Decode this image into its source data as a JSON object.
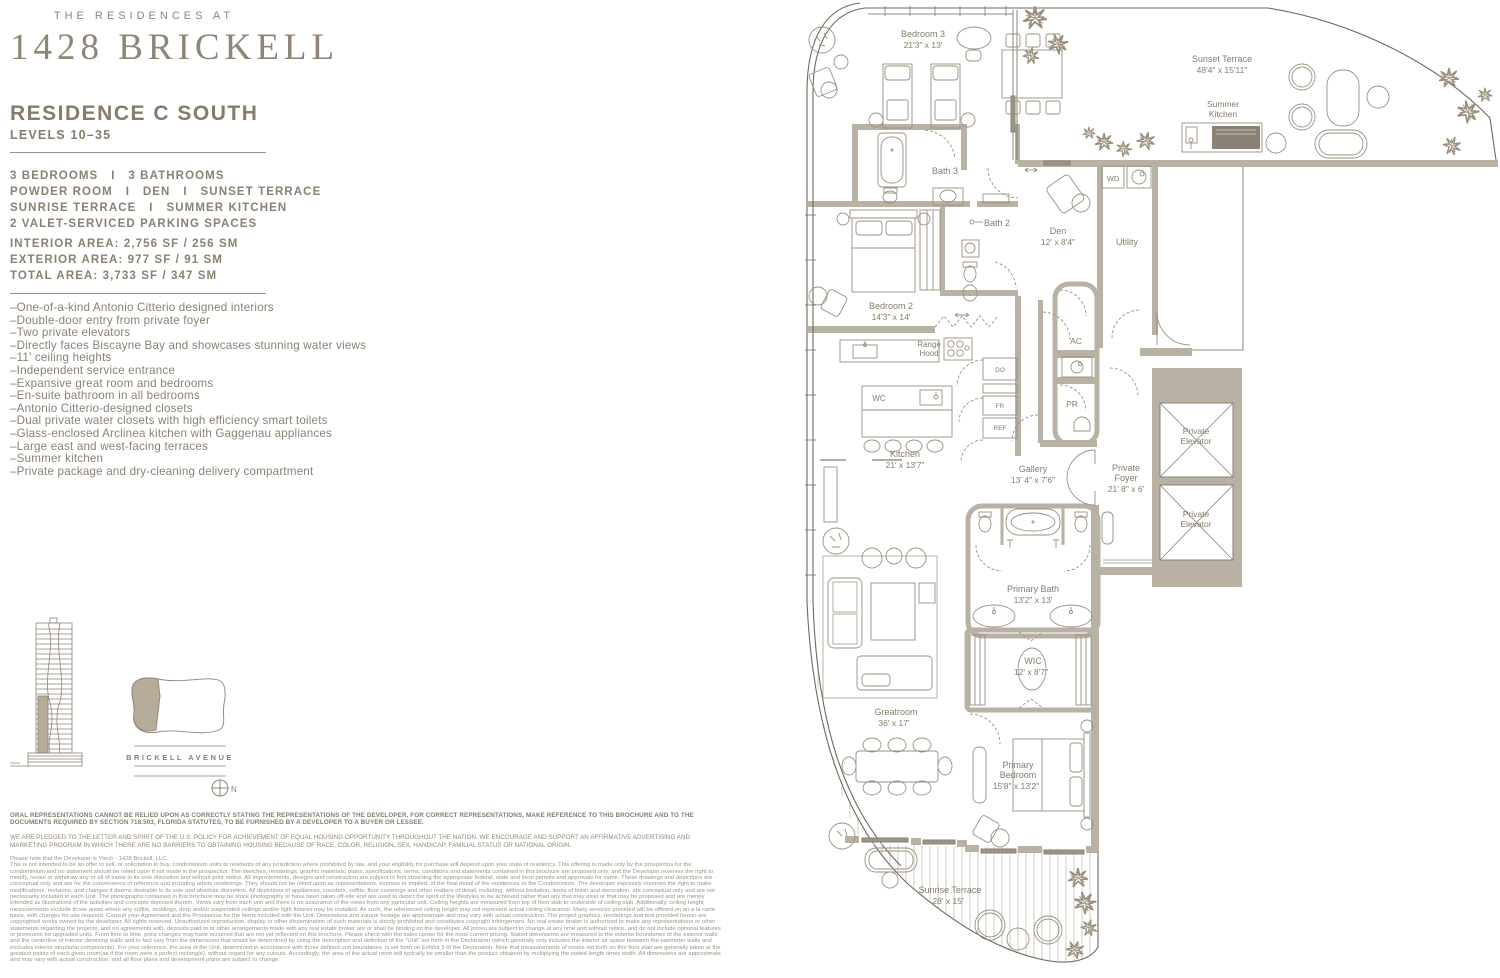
{
  "brand": {
    "tagline": "THE RESIDENCES AT",
    "name": "1428 BRICKELL"
  },
  "residence": {
    "title": "RESIDENCE C SOUTH",
    "levels": "LEVELS 10–35",
    "specs": [
      "3 BEDROOMS   I   3 BATHROOMS",
      "POWDER ROOM   I   DEN   I   SUNSET TERRACE",
      "SUNRISE TERRACE   I   SUMMER KITCHEN",
      "2 VALET-SERVICED PARKING SPACES"
    ],
    "areas": [
      "INTERIOR AREA: 2,756 SF / 256 SM",
      "EXTERIOR AREA: 977 SF / 91 SM",
      "TOTAL AREA: 3,733 SF / 347 SM"
    ],
    "features": [
      "–One-of-a-kind Antonio Citterio designed interiors",
      "–Double-door entry from private foyer",
      "–Two private elevators",
      "–Directly faces Biscayne Bay and showcases stunning water views",
      "–11' ceiling heights",
      "–Independent service entrance",
      "–Expansive great room and bedrooms",
      "–En-suite bathroom in all bedrooms",
      "–Antonio Citterio-designed closets",
      "–Dual private water closets with high efficiency smart toilets",
      "–Glass-enclosed Arclinea kitchen with Gaggenau appliances",
      "–Large east and west-facing terraces",
      "–Summer kitchen",
      "–Private package and dry-cleaning delivery compartment"
    ]
  },
  "site": {
    "street": "BRICKELL AVENUE",
    "compass_north": "N"
  },
  "plan": {
    "labels": {
      "bedroom3": "Bedroom 3",
      "bedroom3_dims": "21'3\" x 13'",
      "bath3": "Bath 3",
      "bath2": "Bath 2",
      "bedroom2": "Bedroom 2",
      "bedroom2_dims": "14'3\" x 14'",
      "den": "Den",
      "den_dims": "12' x 8'4\"",
      "utility": "Utility",
      "wd": "WD",
      "sunset_terrace": "Sunset Terrace",
      "sunset_terrace_dims": "48'4\" x 15'11\"",
      "summer_kitchen_1": "Summer",
      "summer_kitchen_2": "Kitchen",
      "range_hood_1": "Range",
      "range_hood_2": "Hood",
      "wc": "WC",
      "appliance_do": "DO",
      "appliance_fr": "FR",
      "appliance_ref": "REF",
      "ac": "AC",
      "pr": "PR",
      "kitchen": "Kitchen",
      "kitchen_dims": "21' x 13'7\"",
      "gallery": "Gallery",
      "gallery_dims": "13' 4\" x 7'6\"",
      "private_foyer_1": "Private",
      "private_foyer_2": "Foyer",
      "private_foyer_dims": "21' 8\" x 6'",
      "private_elevator_1": "Private",
      "private_elevator_2": "Elevator",
      "primary_bath": "Primary Bath",
      "primary_bath_dims": "13'2\" x 13'",
      "wic": "WIC",
      "wic_dims": "12' x 8'7\"",
      "greatroom": "Greatroom",
      "greatroom_dims": "36' x 17'",
      "primary_bedroom_1": "Primary",
      "primary_bedroom_2": "Bedroom",
      "primary_bedroom_dims": "15'8\" x 13'2\"",
      "sunrise_terrace": "Sunrise Terrace",
      "sunrise_terrace_dims": "28' x 15'"
    }
  },
  "footer": {
    "legal_bold": "ORAL REPRESENTATIONS CANNOT BE RELIED UPON AS CORRECTLY STATING THE REPRESENTATIONS OF THE DEVELOPER. FOR CORRECT REPRESENTATIONS, MAKE REFERENCE TO THIS BROCHURE AND TO THE DOCUMENTS REQUIRED BY SECTION 718.503, FLORIDA STATUTES, TO BE FURNISHED BY A DEVELOPER TO A BUYER OR LESSEE.",
    "fair_housing": "WE ARE PLEDGED TO THE LETTER AND SPIRIT OF THE U.S. POLICY FOR ACHIEVEMENT OF EQUAL HOUSING OPPORTUNITY THROUGHOUT THE NATION. WE ENCOURAGE AND SUPPORT AN AFFIRMATIVE ADVERTISING AND MARKETING PROGRAM IN WHICH THERE ARE NO BARRIERS TO OBTAINING HOUSING BECAUSE OF RACE, COLOR, RELIGION, SEX, HANDICAP, FAMILIAL STATUS OR NATIONAL ORIGIN.",
    "developer_note": "Please note that the Developer is Ytech - 1428 Brickell, LLC.",
    "fine_print": "This is not intended to be an offer to sell, or solicitation to buy, condominium units to residents of any jurisdiction where prohibited by law, and your eligibility for purchase will depend upon your state of residency. This offering is made only by the prospectus for the condominium and no statement should be relied upon if not made in the prospectus. The sketches, renderings, graphic materials, plans, specifications, terms, conditions and statements contained in this brochure are proposed only, and the Developer reserves the right to modify, revise or withdraw any or all of same in its sole discretion and without prior notice. All improvements, designs and construction are subject to first obtaining the appropriate federal, state and local permits and approvals for same. These drawings and depictions are conceptual only and are for the convenience of reference and including artists renderings. They should not be relied upon as representations, express or implied, of the final detail of the residences or the Condominium. The developer expressly reserves the right to make modifications, revisions, and changes it deems desirable in its sole and absolute discretion. All depictions of appliances, counters, soffits, floor coverings and other matters of detail, including, without limitation, items of finish and decoration, are conceptual only and are not necessarily included in each Unit. The photographs contained in this brochure may be stock photography or have been taken off-site and are used to depict the spirit of the lifestyles to be achieved rather than any that may exist or that may be proposed and are merely intended as illustrations of the activities and concepts depicted therein. Views vary from each unit and there is no assurance of the views from any particular unit. Ceiling heights are measured from top of floor slab to underside of ceiling slab. Additionally, ceiling height measurements exclude those areas where any soffits, moldings, drop and/or suspended ceilings and/or light fixtures may be installed. As such, the referenced ceiling height may not represent actual ceiling clearance. Many services provided will be offered on an a la carte basis, with charges for use required. Consult your Agreement and the Prospectus for the items included with the Unit. Dimensions and square footage are approximate and may vary with actual construction. The project graphics, renderings and text provided herein are copyrighted works owned by the developer. All rights reserved. Unauthorized reproduction, display or other dissemination of such materials is strictly prohibited and constitutes copyright infringement. No real estate broker is authorized to make any representations or other statements regarding the projects, and no agreements with, deposits paid to or other arrangements made with any real estate broker are or shall be binding on the developer. All prices are subject to change at any time and without notice, and do not include optional features or premiums for upgraded units. From time to time, price changes may have occurred that are not yet reflected on this brochure. Please check with the sales center for the most current pricing. Stated dimensions are measured to the exterior boundaries of the exterior walls and the centerline of interior demising walls and in fact vary from the dimensions that would be determined by using the description and definition of the \"Unit\" set forth in the Declaration (which generally only includes the interior air space between the perimeter walls and excludes interior structural components). For your reference, the area of the Unit, determined in accordance with those defined unit boundaries, is set forth on Exhibit 3 of the Declaration. Note that measurements of rooms set forth on this floor plan are generally taken at the greatest points of each given room(as if the room were a perfect rectangle), without regard for any cutouts. Accordingly, the area of the actual room will typically be smaller than the product obtained by multiplying the stated length times width. All dimensions are approximate and may vary with actual construction, and all floor plans and development plans are subject to change."
  },
  "colors": {
    "accent": "#8a8173",
    "wall": "#b9b1a3",
    "line": "#9a9181"
  }
}
